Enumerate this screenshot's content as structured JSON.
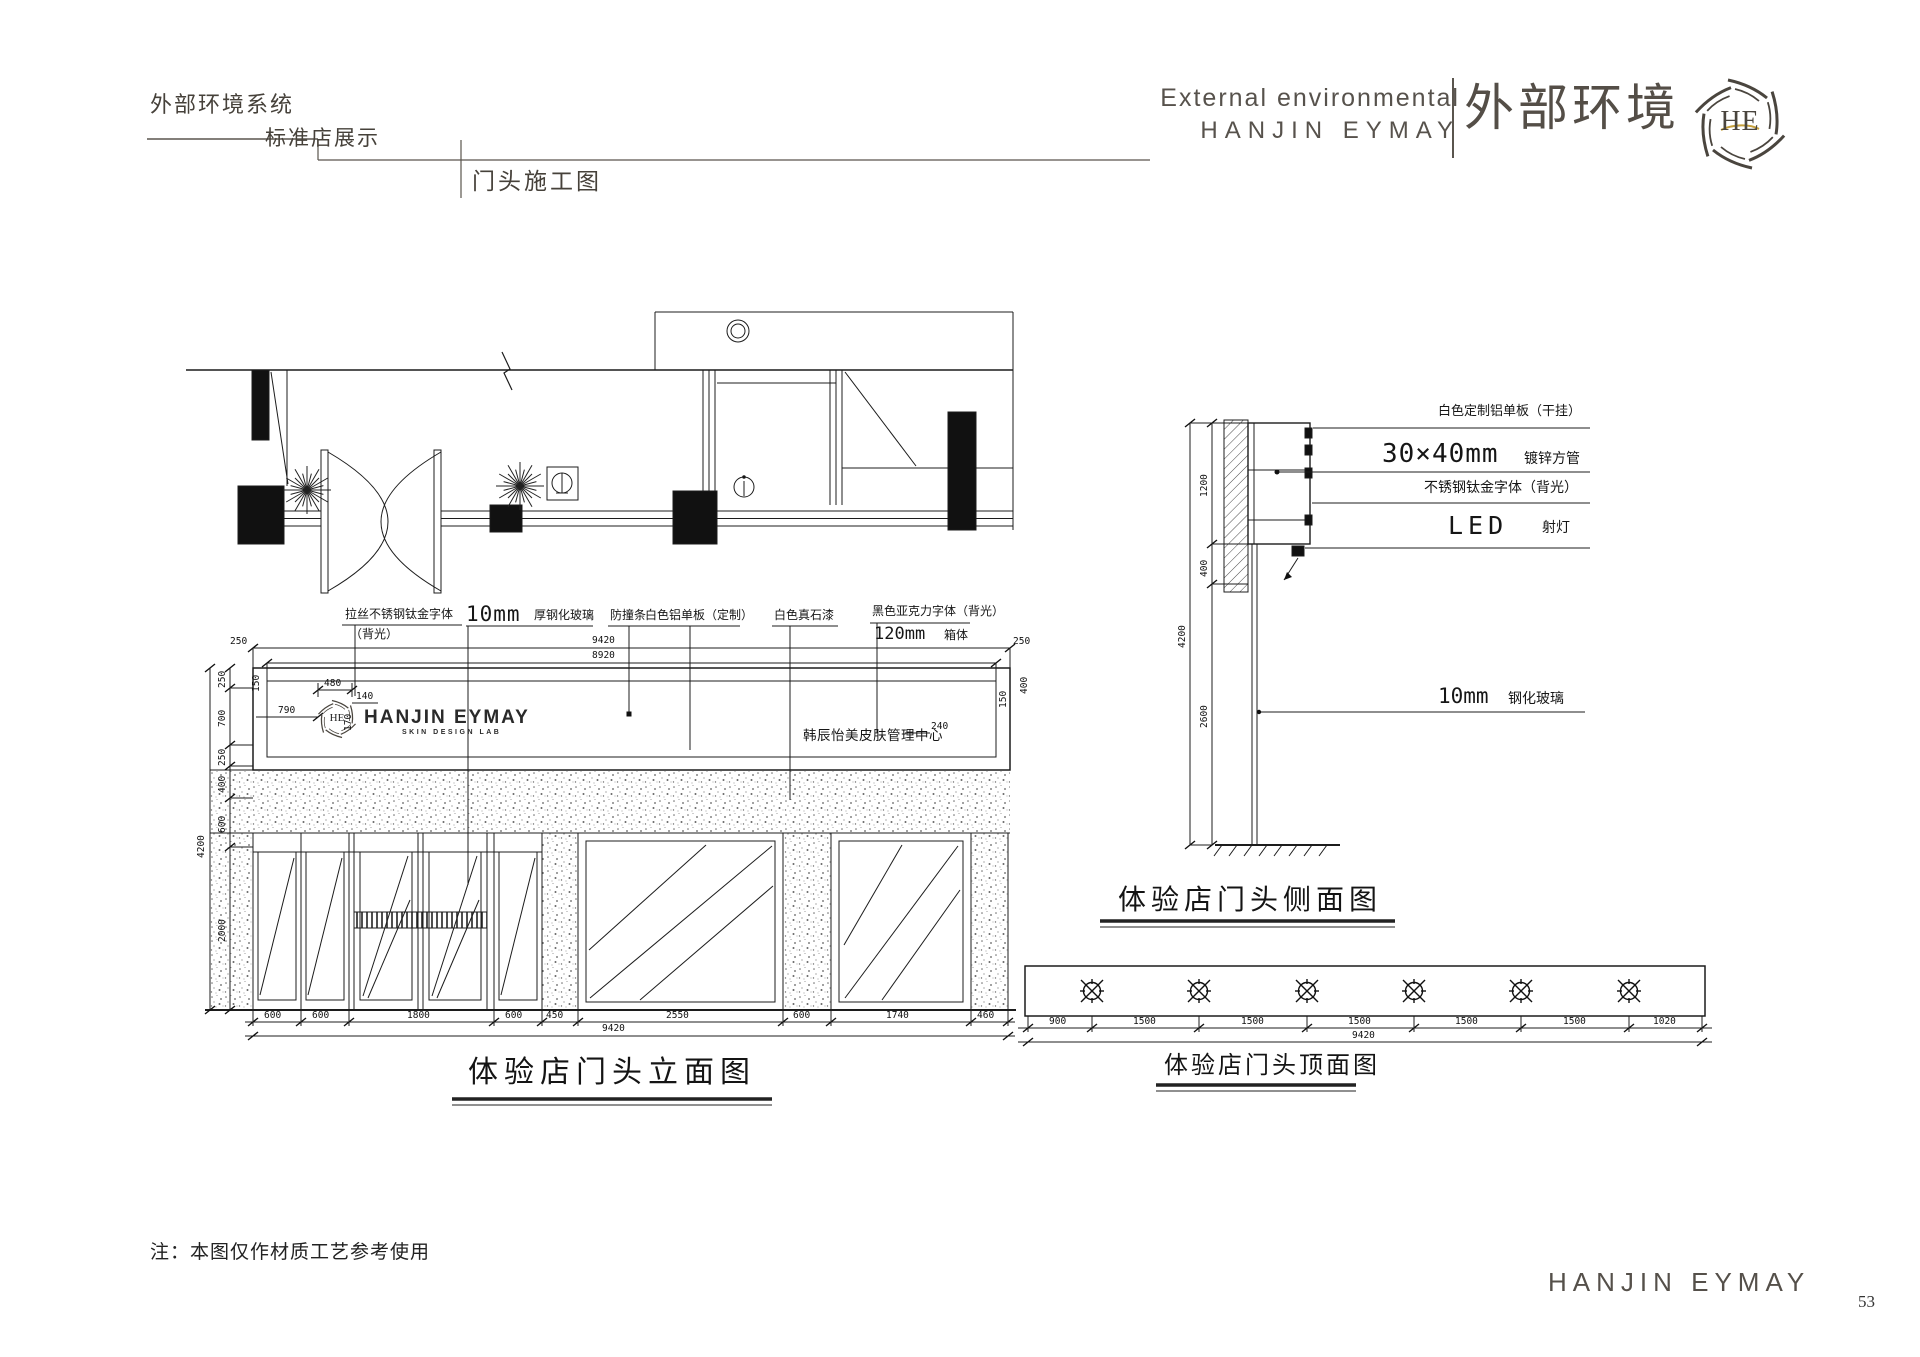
{
  "header": {
    "system": "外部环境系统",
    "section": "标准店展示",
    "sheet": "门头施工图",
    "brand_en_small": "External environmental",
    "brand_en": "HANJIN EYMAY",
    "brand_cn": "外部环境",
    "monogram": "HE"
  },
  "elevation": {
    "title": "体验店门头立面图",
    "callouts": {
      "c1a": "拉丝不锈钢钛金字体",
      "c1b": "（背光）",
      "c2a": "10mm",
      "c2b": "厚钢化玻璃",
      "c3": "防撞条",
      "c4": "白色铝单板（定制）",
      "c5": "白色真石漆",
      "c6a": "黑色亚克力字体（背光）",
      "c6b": "120mm",
      "c6c": "箱体"
    },
    "sign": {
      "monogram": "HE",
      "brand": "HANJIN EYMAY",
      "sub": "SKIN DESIGN LAB",
      "cn": "韩辰怡美皮肤管理中心"
    },
    "dims": {
      "total": "9420",
      "inner": "8920",
      "end_left": "250",
      "end_right": "250",
      "height": "4200",
      "left_chain": [
        "250",
        "700",
        "250",
        "400",
        "600",
        "2000"
      ],
      "sign_dims": {
        "d790": "790",
        "d480": "480",
        "d140": "140",
        "d170": "170",
        "d240": "240",
        "d150l": "150",
        "d150r": "150",
        "d400r": "400"
      },
      "bottom_chain": [
        "600",
        "600",
        "1800",
        "600",
        "450",
        "2550",
        "600",
        "1740",
        "460"
      ],
      "bottom_total": "9420"
    }
  },
  "side_view": {
    "title": "体验店门头侧面图",
    "callouts": {
      "s1": "白色定制铝单板（干挂）",
      "s2a": "30×40mm",
      "s2b": "镀锌方管",
      "s3": "不锈钢钛金字体（背光）",
      "s4a": "LED",
      "s4b": "射灯",
      "s5a": "10mm",
      "s5b": "钢化玻璃"
    },
    "dims": {
      "d1200": "1200",
      "d400": "400",
      "d4200": "4200",
      "d2600": "2600"
    }
  },
  "top_view": {
    "title": "体验店门头顶面图",
    "chain": [
      "900",
      "1500",
      "1500",
      "1500",
      "1500",
      "1500",
      "1020"
    ],
    "total": "9420"
  },
  "footer": {
    "note": "注：本图仅作材质工艺参考使用",
    "brand": "HANJIN EYMAY",
    "page_number": "53"
  }
}
